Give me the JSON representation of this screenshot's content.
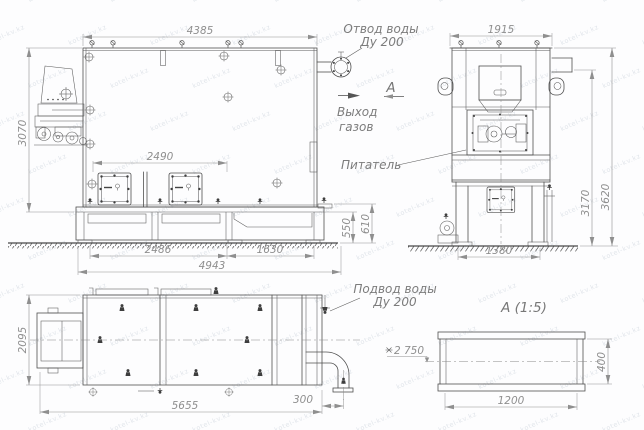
{
  "front": {
    "dim_top": "4385",
    "dim_height": "3070",
    "dim_hatches": "2490",
    "dim_grate": "2486",
    "dim_trough": "1630",
    "dim_base": "4943",
    "dim_h_inner": "550",
    "dim_h_outer": "610"
  },
  "side": {
    "dim_top": "1915",
    "dim_mid": "3170",
    "dim_total": "3620",
    "dim_feet": "1380",
    "feeder_label": "Питатель"
  },
  "plan": {
    "dim_depth": "2095",
    "dim_length": "5655",
    "dim_pipe_offset": "300"
  },
  "detail": {
    "title": "А  (1:5)",
    "dim_width": "1200",
    "dim_height": "400",
    "level_mark": "2 750"
  },
  "notes": {
    "water_out_1": "Отвод воды",
    "water_out_2": "Ду 200",
    "section_letter": "А",
    "gas_out_1": "Выход",
    "gas_out_2": "газов",
    "water_in_1": "Подвод воды",
    "water_in_2": "Ду 200"
  },
  "watermark": {
    "text": "kotel-kv.kz"
  },
  "colors": {
    "line": "#4f4f4f",
    "dim": "#8f8f8f",
    "watermark": "#c9d1da"
  }
}
